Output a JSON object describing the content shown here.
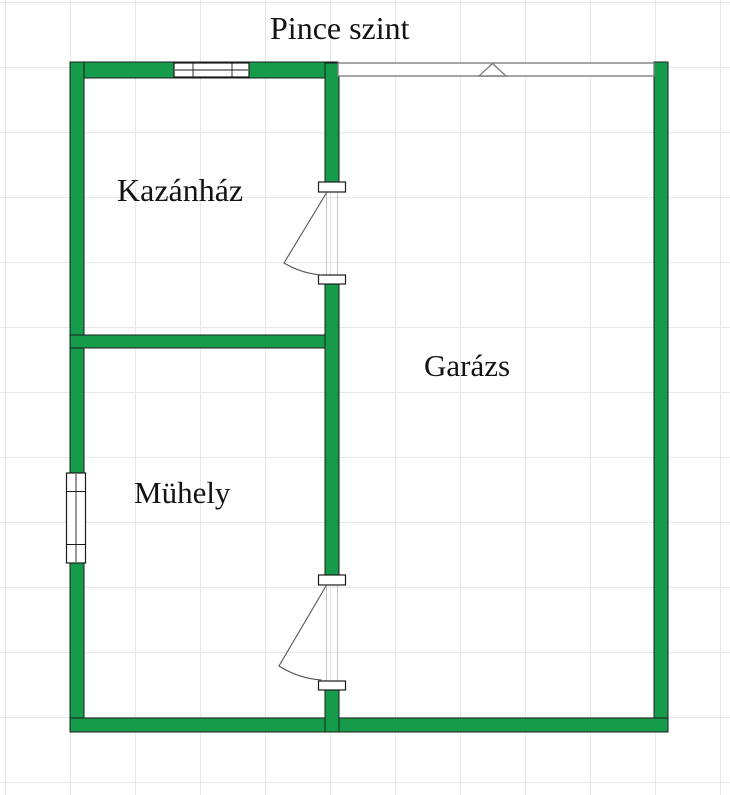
{
  "title": "Pince szint",
  "rooms": [
    {
      "id": "kazanhaz",
      "label": "Kazánház"
    },
    {
      "id": "garazs",
      "label": "Garázs"
    },
    {
      "id": "muhely",
      "label": "Mühely"
    }
  ],
  "elements": {
    "doors_count": 2,
    "windows_count": 2,
    "garage_opening_count": 1
  },
  "colors": {
    "wall_fill": "#169b4a",
    "wall_outline": "#1c1c1c",
    "grid_line": "#e7e7e7",
    "frame_outline": "#1a1a1a",
    "garage_outline": "#7f7f7f",
    "leaf_stroke": "#555555",
    "opening_edge": "#c4c4c4",
    "text_color": "#131313",
    "bg": "#ffffff"
  }
}
